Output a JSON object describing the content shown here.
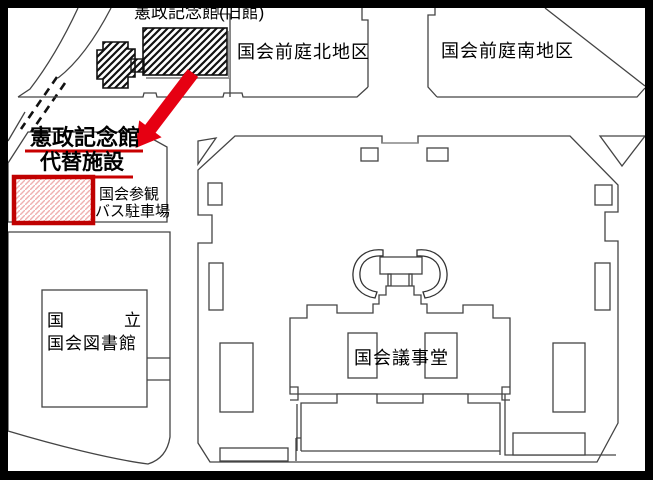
{
  "map": {
    "labels": {
      "old_hall": "憲政記念館(旧館)",
      "north_garden": "国会前庭北地区",
      "south_garden": "国会前庭南地区",
      "annex_line1": "憲政記念館",
      "annex_line2": "代替施設",
      "bus_line1": "国会参観",
      "bus_line2": "バス駐車場",
      "library_line1_left": "国",
      "library_line1_right": "立",
      "library_line2": "国会図書館",
      "diet_building": "国会議事堂"
    },
    "colors": {
      "highlight_red": "#e60012",
      "underline_red": "#c80000",
      "box_border_red": "#c00000",
      "box_hatch_pink": "#f0b0b0",
      "line_gray": "#444444",
      "hatch_black": "#111111"
    }
  }
}
